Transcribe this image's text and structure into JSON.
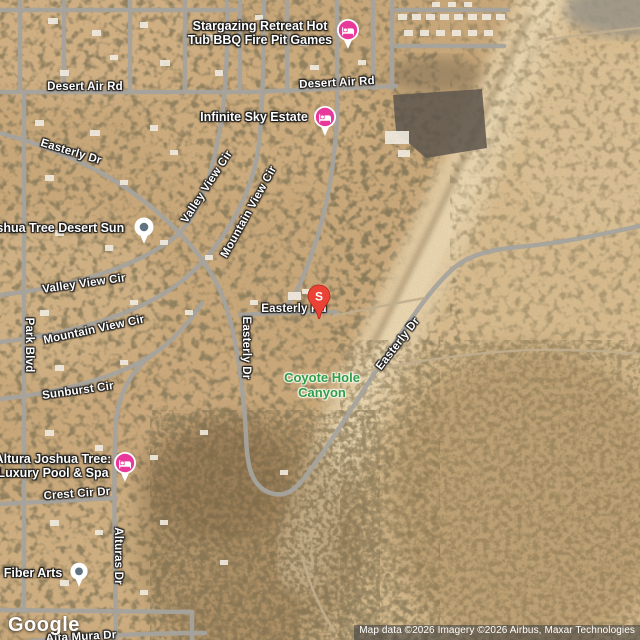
{
  "map_labels": {
    "desert_air_rd_left": "Desert Air Rd",
    "desert_air_rd_right": "Desert Air Rd",
    "easterly_dr_upper": "Easterly Dr",
    "valley_view_cir_upper": "Valley View Cir",
    "mountain_view_cir_upper": "Mountain View Cir",
    "valley_view_cir_left": "Valley View Cir",
    "mountain_view_cir_left": "Mountain View Cir",
    "park_blvd": "Park Blvd",
    "sunburst_cir": "Sunburst Cir",
    "easterly_rd_center": "Easterly Rd",
    "easterly_dr_vertical": "Easterly Dr",
    "easterly_dr_diagonal": "Easterly Dr",
    "crest_cir_dr": "Crest Cir Dr",
    "alturas_dr": "Alturas Dr",
    "alta_mura_dr": "Alta Mura Dr"
  },
  "area_labels": {
    "coyote_hole_canyon": {
      "line1": "Coyote Hole",
      "line2": "Canyon",
      "color": "#2e9e49"
    }
  },
  "pois": {
    "stargazing_retreat": {
      "line1": "Stargazing Retreat Hot",
      "line2": "Tub BBQ Fire Pit Games",
      "icon": "lodging-icon",
      "icon_color": "#e8399a"
    },
    "infinite_sky_estate": {
      "name": "Infinite Sky Estate",
      "icon": "lodging-icon",
      "icon_color": "#e8399a"
    },
    "joshua_tree_desert_sun": {
      "name": "Joshua Tree Desert Sun",
      "icon": "generic-poi-icon",
      "icon_color": "#5f7381"
    },
    "altura_joshua_tree": {
      "line1": "Altura Joshua Tree:",
      "line2": "Luxury Pool & Spa",
      "icon": "lodging-icon",
      "icon_color": "#e8399a"
    },
    "fiber_arts": {
      "name": "Fiber Arts",
      "icon": "generic-poi-icon",
      "icon_color": "#5f7381"
    }
  },
  "marker": {
    "label": "S",
    "color": "#ea4335"
  },
  "footer": {
    "logo_text": "Google",
    "attribution_text": "Map data ©2026 Imagery ©2026 Airbus, Maxar Technologies"
  }
}
